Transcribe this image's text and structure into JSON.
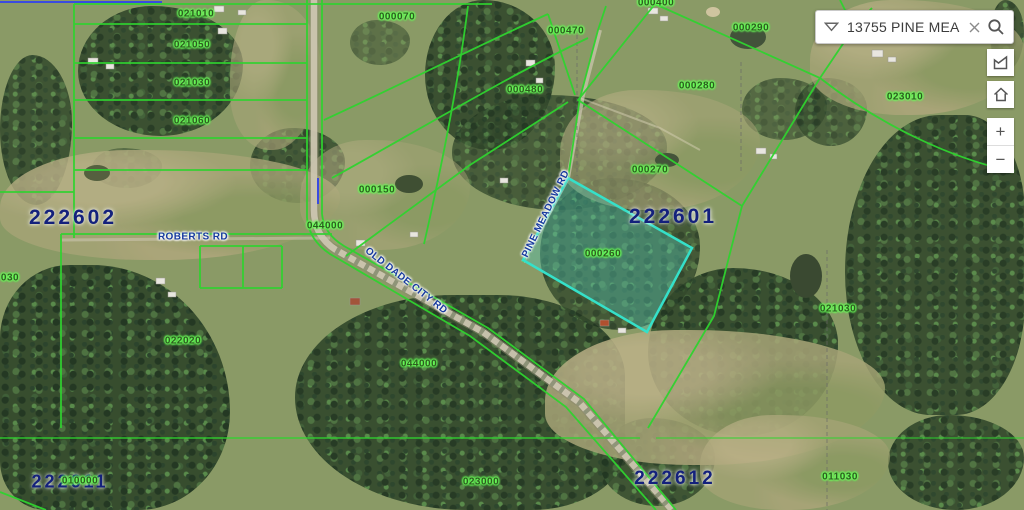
{
  "search": {
    "value": "13755 PINE MEADO",
    "dropdown_icon": "chevron-down",
    "clear_icon": "close-x",
    "search_icon": "magnifier"
  },
  "controls": {
    "polygon_tool_icon": "polygon-select",
    "home_icon": "home",
    "zoom_in_label": "+",
    "zoom_out_label": "−"
  },
  "map": {
    "colors": {
      "parcel_line": "#2fd32f",
      "section_line_blue": "#3a4ae0",
      "highlight_fill": "rgba(80,200,185,0.38)",
      "highlight_stroke": "#35e0c9",
      "section_text": "#14217c",
      "parcel_text_glow": "#6aff5a",
      "road_text": "#173a9e"
    },
    "highlight_parcel": {
      "id": "000260",
      "points": "568,178 692,248 647,332 523,260"
    },
    "parcel_labels": [
      {
        "text": "021010",
        "x": 196,
        "y": 14
      },
      {
        "text": "021050",
        "x": 192,
        "y": 45
      },
      {
        "text": "021030",
        "x": 192,
        "y": 83
      },
      {
        "text": "021060",
        "x": 192,
        "y": 121
      },
      {
        "text": "000070",
        "x": 397,
        "y": 17
      },
      {
        "text": "000470",
        "x": 566,
        "y": 31
      },
      {
        "text": "000400",
        "x": 656,
        "y": 3
      },
      {
        "text": "000290",
        "x": 751,
        "y": 28
      },
      {
        "text": "000280",
        "x": 697,
        "y": 86
      },
      {
        "text": "023010",
        "x": 905,
        "y": 97
      },
      {
        "text": "000480",
        "x": 525,
        "y": 90
      },
      {
        "text": "000150",
        "x": 377,
        "y": 190
      },
      {
        "text": "044000",
        "x": 325,
        "y": 226
      },
      {
        "text": "000270",
        "x": 650,
        "y": 170
      },
      {
        "text": "000260",
        "x": 603,
        "y": 254
      },
      {
        "text": "022020",
        "x": 183,
        "y": 341
      },
      {
        "text": "044000",
        "x": 419,
        "y": 364
      },
      {
        "text": "021030",
        "x": 838,
        "y": 309
      },
      {
        "text": "023000",
        "x": 481,
        "y": 482
      },
      {
        "text": "011030",
        "x": 840,
        "y": 477
      },
      {
        "text": "010000",
        "x": 80,
        "y": 481
      },
      {
        "text": "030",
        "x": 10,
        "y": 278
      }
    ],
    "section_labels": [
      {
        "text": "222602",
        "x": 73,
        "y": 218,
        "size": 21
      },
      {
        "text": "222601",
        "x": 673,
        "y": 217,
        "size": 21
      },
      {
        "text": "222612",
        "x": 675,
        "y": 479,
        "size": 19
      },
      {
        "text": "222611",
        "x": 70,
        "y": 482,
        "size": 18
      }
    ],
    "road_labels": [
      {
        "text": "ROBERTS RD",
        "x": 193,
        "y": 237,
        "rot": 0
      },
      {
        "text": "OLD DADE CITY RD",
        "x": 406,
        "y": 281,
        "rot": 38
      },
      {
        "text": "PINE MEADOW RD",
        "x": 546,
        "y": 214,
        "rot": -64
      }
    ]
  }
}
